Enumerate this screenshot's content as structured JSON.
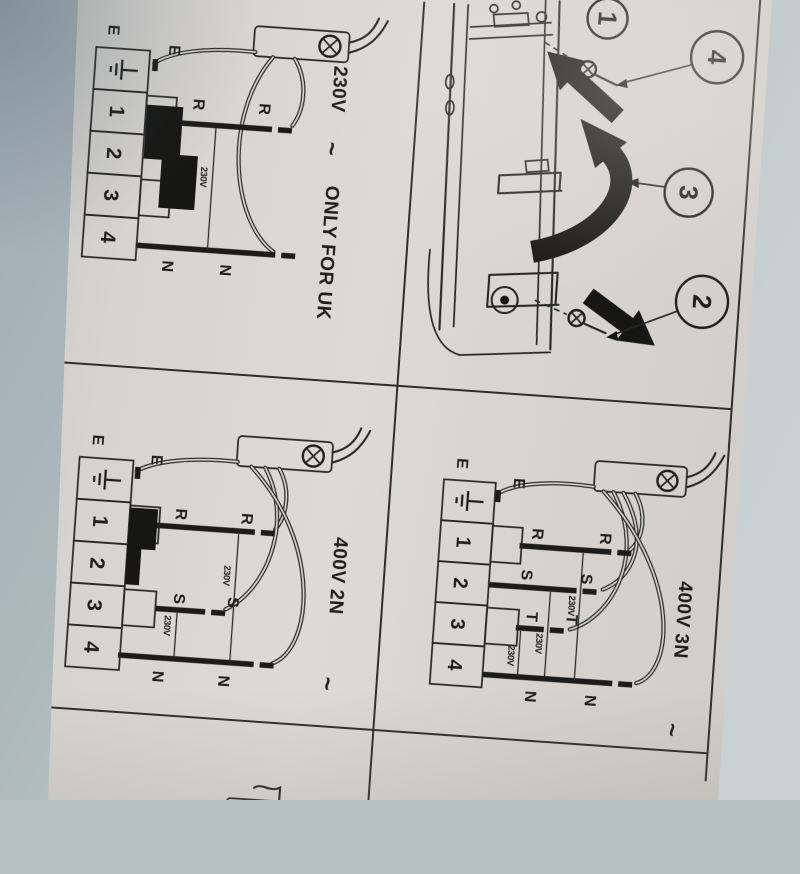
{
  "photo": {
    "background_top_color": "#9fadb4",
    "background_bottom_color": "#cbd2d5",
    "paper_color": "#d9d7d3",
    "ink_color": "#1d1d1b"
  },
  "diagrams": {
    "uk230": {
      "title": "230V",
      "tilde": "~",
      "note": "ONLY FOR UK",
      "terminals": [
        "1",
        "2",
        "3",
        "4"
      ],
      "labels": {
        "r": "R",
        "n": "N",
        "e": "E"
      },
      "marks": [
        "230V"
      ]
    },
    "v400_2n": {
      "title": "400V 2N",
      "tilde": "~",
      "terminals": [
        "1",
        "2",
        "3",
        "4"
      ],
      "labels": {
        "r": "R",
        "s": "S",
        "n": "N",
        "e": "E"
      },
      "marks": [
        "230V",
        "230V"
      ]
    },
    "v400_3n": {
      "title": "400V 3N",
      "tilde": "~",
      "terminals": [
        "1",
        "2",
        "3",
        "4"
      ],
      "labels": {
        "r": "R",
        "s": "S",
        "t": "T",
        "n": "N",
        "e": "E"
      },
      "marks": [
        "230V",
        "230V",
        "230V"
      ]
    }
  },
  "exploded": {
    "callouts": {
      "c1": "1",
      "c2": "2",
      "c3": "3",
      "c4": "4"
    }
  }
}
